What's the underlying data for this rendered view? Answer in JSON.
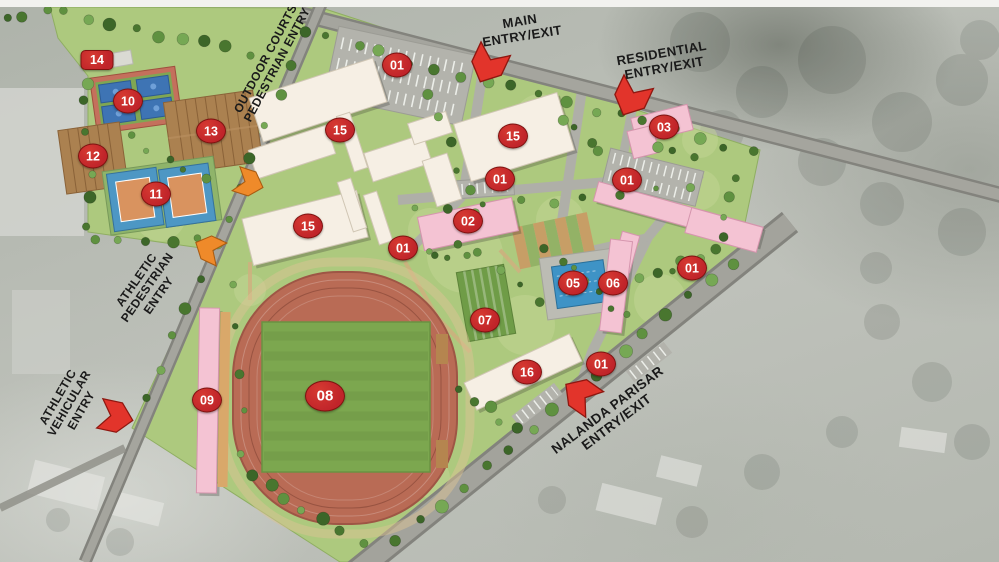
{
  "title": "Sports campus site plan",
  "colors": {
    "marker_red": "#c0242a",
    "arrow_red": "#e2342b",
    "arrow_orange": "#ef8a2a",
    "building_cream": "#f6efe4",
    "building_pink": "#f4c3d3",
    "site_green": "#adc97e",
    "track_terracotta": "#b96b55",
    "pool_blue": "#3e93c6",
    "label_text": "#1a1a1a"
  },
  "entries": [
    {
      "id": "main-entry",
      "text": "MAIN\nENTRY/EXIT",
      "arrow": "red"
    },
    {
      "id": "residential-entry",
      "text": "RESIDENTIAL\nENTRY/EXIT",
      "arrow": "red"
    },
    {
      "id": "outdoor-courts-pedestrian-entry",
      "text": "OUTDOOR COURTS\nPEDESTRIAN ENTRY",
      "arrow": "orange"
    },
    {
      "id": "athletic-pedestrian-entry",
      "text": "ATHLETIC\nPEDESTRIAN\nENTRY",
      "arrow": "orange"
    },
    {
      "id": "athletic-vehicular-entry",
      "text": "ATHLETIC\nVEHICULAR\nENTRY",
      "arrow": "red"
    },
    {
      "id": "nalanda-parisar-entry",
      "text": "NALANDA PARISAR\nENTRY/EXIT",
      "arrow": "red"
    }
  ],
  "markers": [
    {
      "label": "01",
      "x": 397,
      "y": 65
    },
    {
      "label": "01",
      "x": 500,
      "y": 179
    },
    {
      "label": "01",
      "x": 627,
      "y": 180
    },
    {
      "label": "01",
      "x": 403,
      "y": 248
    },
    {
      "label": "01",
      "x": 692,
      "y": 268
    },
    {
      "label": "01",
      "x": 601,
      "y": 364
    },
    {
      "label": "02",
      "x": 468,
      "y": 221
    },
    {
      "label": "03",
      "x": 664,
      "y": 127
    },
    {
      "label": "05",
      "x": 573,
      "y": 283
    },
    {
      "label": "06",
      "x": 613,
      "y": 283
    },
    {
      "label": "07",
      "x": 485,
      "y": 320
    },
    {
      "label": "08",
      "x": 325,
      "y": 396,
      "size": "large"
    },
    {
      "label": "09",
      "x": 207,
      "y": 400
    },
    {
      "label": "10",
      "x": 128,
      "y": 101
    },
    {
      "label": "11",
      "x": 156,
      "y": 194
    },
    {
      "label": "12",
      "x": 93,
      "y": 156
    },
    {
      "label": "13",
      "x": 211,
      "y": 131
    },
    {
      "label": "14",
      "x": 97,
      "y": 60,
      "shape": "rect"
    },
    {
      "label": "15",
      "x": 340,
      "y": 130
    },
    {
      "label": "15",
      "x": 513,
      "y": 136
    },
    {
      "label": "15",
      "x": 308,
      "y": 226
    },
    {
      "label": "16",
      "x": 527,
      "y": 372
    }
  ]
}
